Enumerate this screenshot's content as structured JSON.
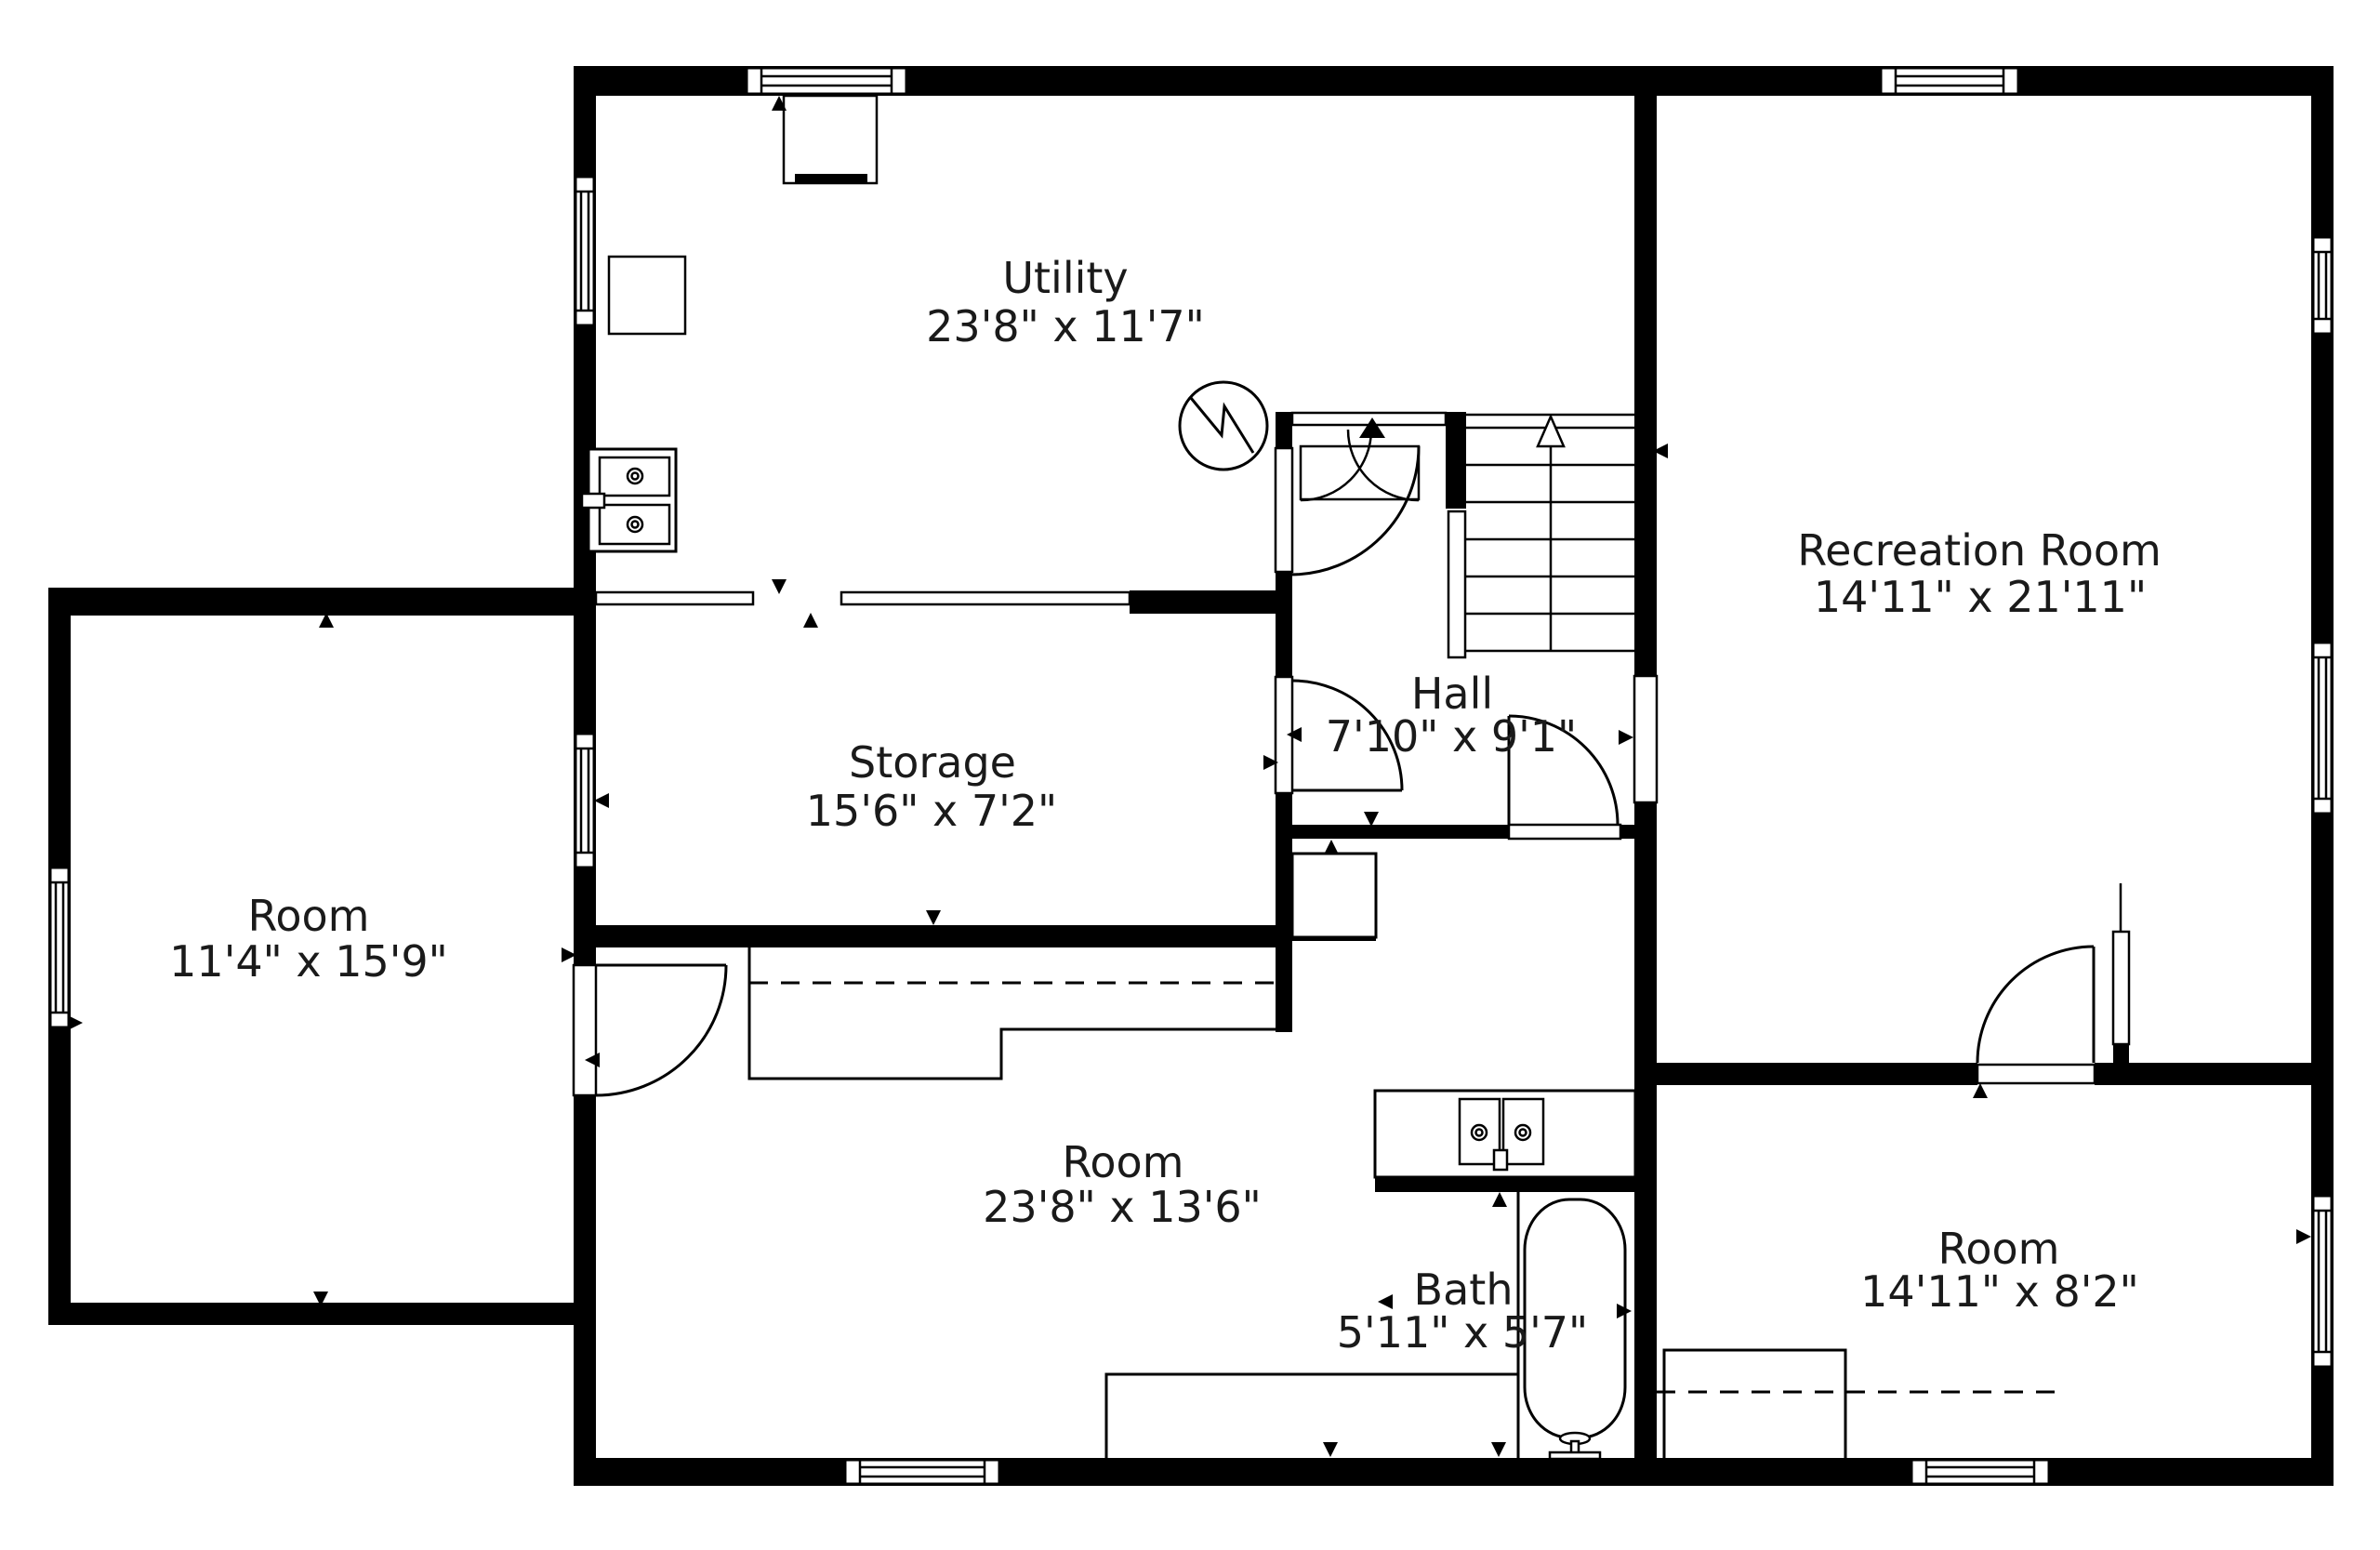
{
  "floorplan": {
    "rooms": [
      {
        "id": "utility",
        "name": "Utility",
        "dims": "23'8\" x 11'7\""
      },
      {
        "id": "storage",
        "name": "Storage",
        "dims": "15'6\" x 7'2\""
      },
      {
        "id": "hall",
        "name": "Hall",
        "dims": "7'10\" x 9'1\""
      },
      {
        "id": "recreation-room",
        "name": "Recreation Room",
        "dims": "14'11\" x 21'11\""
      },
      {
        "id": "room-left",
        "name": "Room",
        "dims": "11'4\" x 15'9\""
      },
      {
        "id": "room-middle",
        "name": "Room",
        "dims": "23'8\" x 13'6\""
      },
      {
        "id": "bath",
        "name": "Bath",
        "dims": "5'11\" x 5'7\""
      },
      {
        "id": "room-bottom-right",
        "name": "Room",
        "dims": "14'11\" x 8'2\""
      }
    ],
    "fixtures": [
      "staircase-up",
      "double-laundry-sink",
      "double-vanity-sink",
      "bathtub",
      "washer",
      "freezer",
      "electrical-panel",
      "closet-rod-dashed"
    ],
    "colors": {
      "wall": "#000000",
      "floor": "#ffffff",
      "text": "#1a1a1a"
    }
  }
}
